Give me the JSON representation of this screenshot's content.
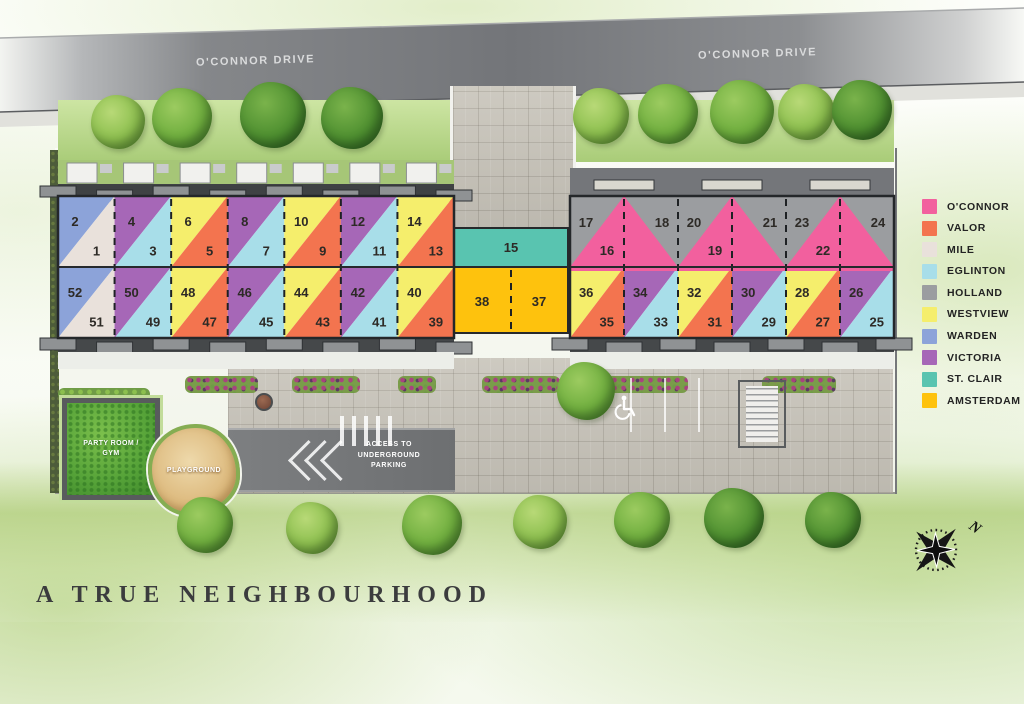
{
  "title": "A TRUE NEIGHBOURHOOD",
  "streets": {
    "left": "O'CONNOR DRIVE",
    "right": "O'CONNOR DRIVE"
  },
  "legend": {
    "items": [
      {
        "name": "O'CONNOR",
        "color": "#F2609E"
      },
      {
        "name": "VALOR",
        "color": "#F3744F"
      },
      {
        "name": "MILE",
        "color": "#E9E1DB"
      },
      {
        "name": "EGLINTON",
        "color": "#A8DEE9"
      },
      {
        "name": "HOLLAND",
        "color": "#9B9DA0"
      },
      {
        "name": "WESTVIEW",
        "color": "#F5EE6C"
      },
      {
        "name": "WARDEN",
        "color": "#8CA3D9"
      },
      {
        "name": "VICTORIA",
        "color": "#A667B7"
      },
      {
        "name": "ST. CLAIR",
        "color": "#59C4B0"
      },
      {
        "name": "AMSTERDAM",
        "color": "#FEC20D"
      }
    ]
  },
  "site": {
    "left_block": {
      "row_top": [
        {
          "upper": "2",
          "lower": "1",
          "upper_plan": "WARDEN",
          "lower_plan": "MILE"
        },
        {
          "upper": "4",
          "lower": "3",
          "upper_plan": "VICTORIA",
          "lower_plan": "EGLINTON"
        },
        {
          "upper": "6",
          "lower": "5",
          "upper_plan": "WESTVIEW",
          "lower_plan": "VALOR"
        },
        {
          "upper": "8",
          "lower": "7",
          "upper_plan": "VICTORIA",
          "lower_plan": "EGLINTON"
        },
        {
          "upper": "10",
          "lower": "9",
          "upper_plan": "WESTVIEW",
          "lower_plan": "VALOR"
        },
        {
          "upper": "12",
          "lower": "11",
          "upper_plan": "VICTORIA",
          "lower_plan": "EGLINTON"
        },
        {
          "upper": "14",
          "lower": "13",
          "upper_plan": "WESTVIEW",
          "lower_plan": "VALOR"
        }
      ],
      "row_bottom": [
        {
          "upper": "52",
          "lower": "51",
          "upper_plan": "WARDEN",
          "lower_plan": "MILE"
        },
        {
          "upper": "50",
          "lower": "49",
          "upper_plan": "VICTORIA",
          "lower_plan": "EGLINTON"
        },
        {
          "upper": "48",
          "lower": "47",
          "upper_plan": "WESTVIEW",
          "lower_plan": "VALOR"
        },
        {
          "upper": "46",
          "lower": "45",
          "upper_plan": "VICTORIA",
          "lower_plan": "EGLINTON"
        },
        {
          "upper": "44",
          "lower": "43",
          "upper_plan": "WESTVIEW",
          "lower_plan": "VALOR"
        },
        {
          "upper": "42",
          "lower": "41",
          "upper_plan": "VICTORIA",
          "lower_plan": "EGLINTON"
        },
        {
          "upper": "40",
          "lower": "39",
          "upper_plan": "WESTVIEW",
          "lower_plan": "VALOR"
        }
      ]
    },
    "middle_units": {
      "unit15": {
        "label": "15",
        "plan": "ST. CLAIR"
      },
      "unit38": {
        "label": "38",
        "plan": "AMSTERDAM"
      },
      "unit37": {
        "label": "37",
        "plan": "AMSTERDAM"
      }
    },
    "right_block": {
      "row_top": {
        "base_plan": "HOLLAND",
        "triangle_plan": "O'CONNOR",
        "pairs": [
          {
            "left": "17",
            "right": "18",
            "triangle": "16"
          },
          {
            "left": "20",
            "right": "21",
            "triangle": "19"
          },
          {
            "left": "23",
            "right": "24",
            "triangle": "22"
          }
        ]
      },
      "row_bottom": [
        {
          "upper": "36",
          "lower": "35",
          "upper_plan": "WESTVIEW",
          "lower_plan": "VALOR"
        },
        {
          "upper": "34",
          "lower": "33",
          "upper_plan": "VICTORIA",
          "lower_plan": "EGLINTON"
        },
        {
          "upper": "32",
          "lower": "31",
          "upper_plan": "WESTVIEW",
          "lower_plan": "VALOR"
        },
        {
          "upper": "30",
          "lower": "29",
          "upper_plan": "VICTORIA",
          "lower_plan": "EGLINTON"
        },
        {
          "upper": "28",
          "lower": "27",
          "upper_plan": "WESTVIEW",
          "lower_plan": "VALOR"
        },
        {
          "upper": "26",
          "lower": "25",
          "upper_plan": "VICTORIA",
          "lower_plan": "EGLINTON"
        }
      ]
    }
  },
  "amenities": {
    "party_room": "PARTY ROOM / GYM",
    "playground": "PLAYGROUND",
    "parking_access": "ACCESS TO UNDERGROUND PARKING"
  },
  "compass": {
    "north": "N"
  }
}
